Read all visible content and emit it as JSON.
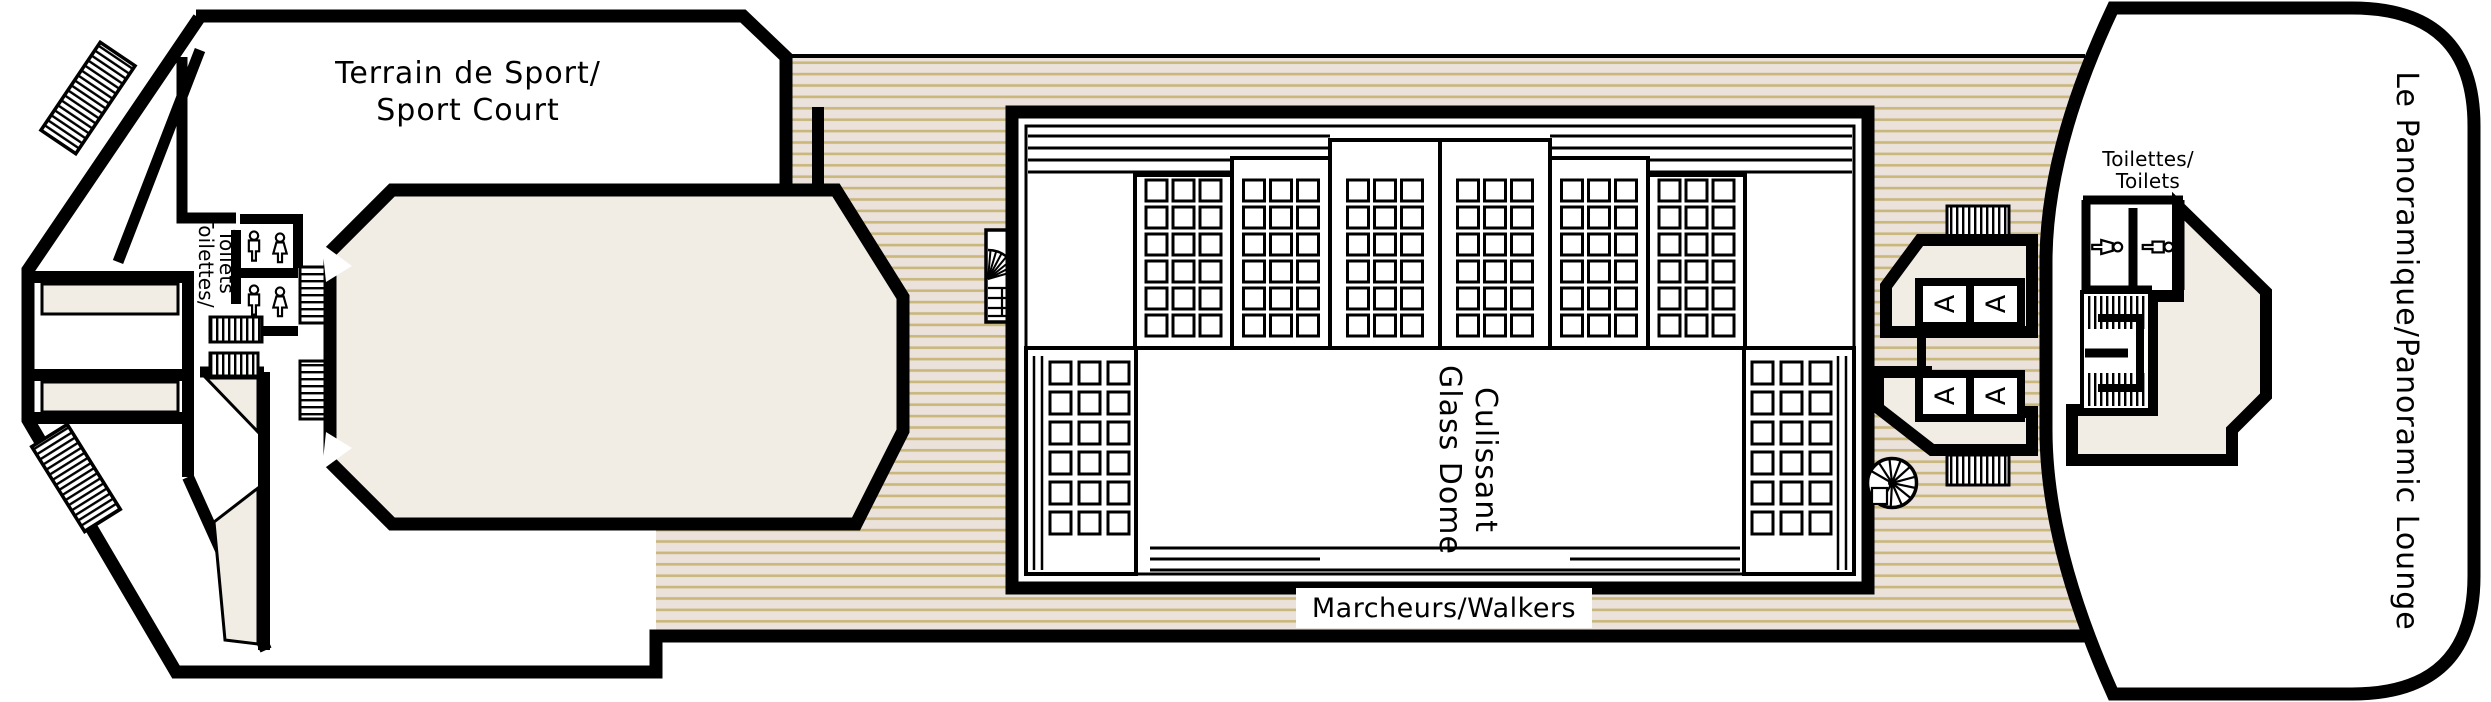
{
  "plan": {
    "type": "cruise-ship-deck-plan",
    "labels": {
      "sport_court": {
        "line1": "Terrain de Sport/",
        "line2": "Sport Court"
      },
      "bow_toilets": {
        "line1": "Toilettes/",
        "line2": "Toilets"
      },
      "dome": {
        "line1": "Culissant",
        "line2": "Glass Dome"
      },
      "walkers": {
        "text": "Marcheurs/Walkers"
      },
      "stern_toilets": {
        "line1": "Toilettes/",
        "line2": "Toilets"
      },
      "lounge": {
        "text": "Le Panoramique/Panoramic Lounge"
      },
      "elevator_cab": "A"
    },
    "colors": {
      "outline": "#000000",
      "room_fill": "#f1ece4",
      "deck_background": "#eae2db",
      "deck_stripe": "#c9b77b",
      "paper": "#ffffff"
    },
    "icons": {
      "diagonal_stairs": "hatched-stairs-icon",
      "straight_stairs": "tread-stairs-icon",
      "spiral_stairs": "spiral-stairs-icon",
      "elevator": "elevator-cab",
      "male": "male-figure-icon",
      "female": "female-figure-icon"
    }
  }
}
